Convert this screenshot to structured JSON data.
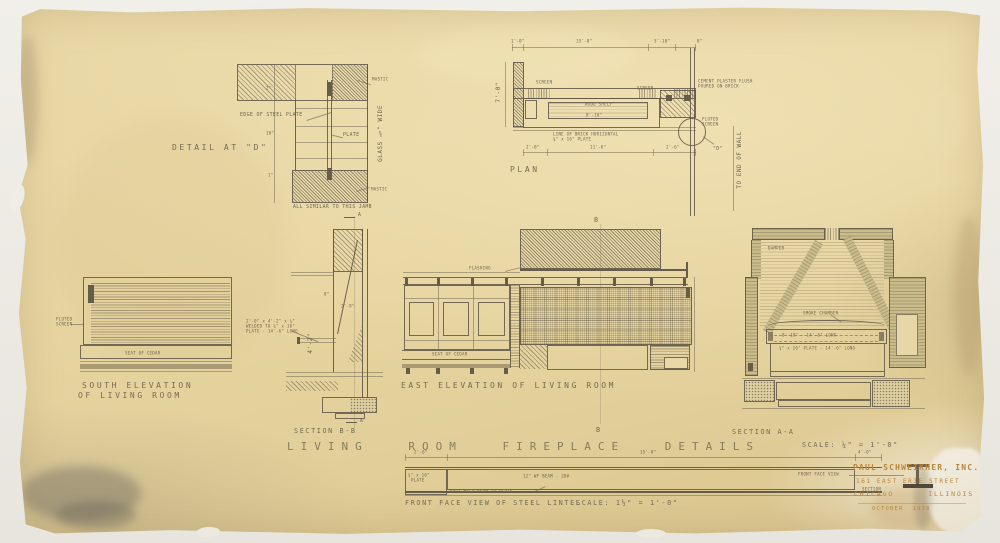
{
  "sheet": {
    "main_title": "LIVING ROOM FIREPLACE DETAILS",
    "main_scale": "SCALE: ¼\" = 1'-0\""
  },
  "detail_d": {
    "title": "DETAIL AT \"D\"",
    "edge_note": "EDGE OF STEEL PLATE",
    "plate_label": "PLATE",
    "mastic_top": "MASTIC",
    "mastic_bottom": "MASTIC",
    "glass_note": "GLASS ¾\" WIDE",
    "jamb_note": "ALL SIMILAR TO THIS JAMB",
    "dim_top": "2\"",
    "dim_mid": "10\"",
    "dim_bottom": "1\""
  },
  "plan": {
    "title": "PLAN",
    "dim_top_left": "1'-0\"",
    "dim_top_mid": "15'-0\"",
    "dim_top_right": "5'-10\"",
    "dim_top_end": "8\"",
    "dim_left": "7'-0\"",
    "dim_bottom_left": "2'-0\"",
    "dim_bottom_mid": "11'-6\"",
    "dim_bottom_right": "2'-6\"",
    "screen_left": "SCREEN",
    "screen_right": "SCREEN",
    "wood_shelf": "WOOD SHELF",
    "shelf_dim": "8'-10\"",
    "brick_note_1": "LINE OF BRICK HORIZONTAL",
    "brick_note_2": "¾\" x 16\" PLATE",
    "cement_note_1": "CEMENT PLASTER FLUSH",
    "cement_note_2": "POURED ON BRICK",
    "fluted_screen_1": "FLUTED",
    "fluted_screen_2": "SCREEN",
    "detail_marker": "\"D\"",
    "wall_note": "TO END OF WALL"
  },
  "south_elevation": {
    "title_line1": "SOUTH ELEVATION",
    "title_line2": "OF LIVING ROOM",
    "seat_label": "SEAT OF CEDAR",
    "screen_label_1": "FLUTED",
    "screen_label_2": "SCREEN"
  },
  "section_bb": {
    "title": "SECTION B-B",
    "marker_top": "A",
    "marker_bottom": "A",
    "dim_1": "8\"",
    "dim_2": "2'-9\"",
    "dim_3": "4'-2\"",
    "plate_note_1": "2'-0\" x 4'-2\" x ¼\"",
    "plate_note_2": "WELDED TO ¾\" x 16\"",
    "plate_note_3": "PLATE - 14'-6\" LONG"
  },
  "east_elevation": {
    "title": "EAST ELEVATION OF LIVING ROOM",
    "flashing_label": "FLASHING",
    "seat_label": "SEAT OF CEDAR",
    "marker_top": "B",
    "marker_bottom": "B"
  },
  "section_aa": {
    "title": "SECTION A-A",
    "damper_label": "DAMPER",
    "smoke_chamber_label": "SMOKE CHAMBER",
    "opening_note": "8'-10\" - 14'-6\" LONG",
    "plate_note": "¾\" x 16\" PLATE - 14'-6\" LONG"
  },
  "lintel": {
    "title": "FRONT FACE VIEW OF STEEL LINTEL",
    "scale": "SCALE: 1½\" = 1'-0\"",
    "dim_left": "2'-6\"",
    "dim_mid": "15'-0\"",
    "dim_right": "4'-0\"",
    "beam_label": "12\" WF BEAM - 28#",
    "plate_label_1": "¾\" x 16\"",
    "plate_label_2": "PLATE",
    "weld_note": "SPOT-WELD BEAM TO PLATE",
    "mini_view_label": "FRONT FACE VIEW",
    "mini_section_label": "SECTION"
  },
  "title_block": {
    "firm": "PAUL SCHWEIKHER, INC.",
    "address": "161 EAST ERIE STREET",
    "city": "CHICAGO      ILLINOIS",
    "date": "OCTOBER  1938"
  }
}
